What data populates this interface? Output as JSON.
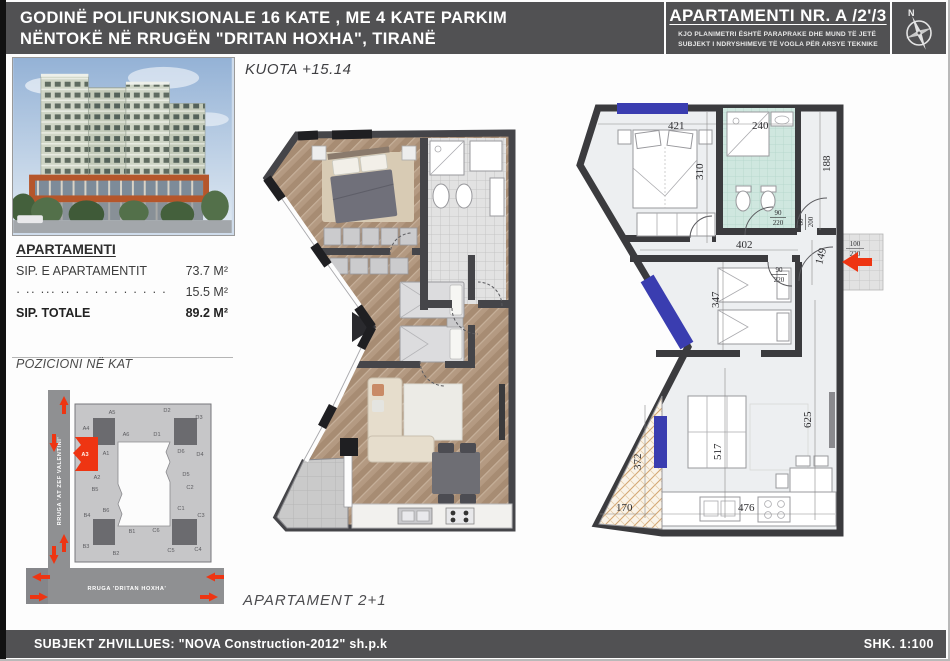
{
  "header": {
    "title_line1": "GODINË POLIFUNKSIONALE 16 KATE , ME 4 KATE PARKIM",
    "title_line2": "NËNTOKË NË RRUGËN \"DRITAN HOXHA\", TIRANË",
    "apartment_no": "APARTAMENTI NR. A /2'/3",
    "disclaimer1": "KJO PLANIMETRI ËSHTË PARAPRAKE DHE MUND TË JETË",
    "disclaimer2": "SUBJEKT I NDRYSHIMEVE TË VOGLA PËR ARSYE TEKNIKE",
    "compass": "N"
  },
  "sidebar": {
    "apartment_table": {
      "heading": "APARTAMENTI",
      "rows": [
        {
          "label": "SIP. E APARTAMENTIT",
          "value": "73.7 M²"
        },
        {
          "label": "· ·· ··· ·· · · · · · · · · · ·",
          "value": "15.5 M²"
        },
        {
          "label": "SIP. TOTALE",
          "value": "89.2 M²"
        }
      ]
    },
    "position_title": "POZICIONI NË KAT",
    "map": {
      "street_vertical": "RRUGA 'AT ZEF VALENTINI'",
      "street_horizontal": "RRUGA 'DRITAN HOXHA'",
      "highlight_unit": "A3",
      "units": [
        {
          "id": "A5",
          "x": 112,
          "y": 414
        },
        {
          "id": "D2",
          "x": 167,
          "y": 412
        },
        {
          "id": "D3",
          "x": 199,
          "y": 419
        },
        {
          "id": "A4",
          "x": 86,
          "y": 430
        },
        {
          "id": "A6",
          "x": 126,
          "y": 436
        },
        {
          "id": "D1",
          "x": 157,
          "y": 436
        },
        {
          "id": "A3",
          "x": 85,
          "y": 456,
          "hl": true
        },
        {
          "id": "A1",
          "x": 106,
          "y": 455
        },
        {
          "id": "D6",
          "x": 181,
          "y": 453
        },
        {
          "id": "D4",
          "x": 200,
          "y": 456
        },
        {
          "id": "A2",
          "x": 97,
          "y": 479
        },
        {
          "id": "D5",
          "x": 186,
          "y": 476
        },
        {
          "id": "B5",
          "x": 95,
          "y": 491
        },
        {
          "id": "C2",
          "x": 190,
          "y": 489
        },
        {
          "id": "B6",
          "x": 106,
          "y": 512
        },
        {
          "id": "C1",
          "x": 181,
          "y": 510
        },
        {
          "id": "B4",
          "x": 87,
          "y": 517
        },
        {
          "id": "C3",
          "x": 201,
          "y": 517
        },
        {
          "id": "B1",
          "x": 132,
          "y": 533
        },
        {
          "id": "C6",
          "x": 156,
          "y": 532
        },
        {
          "id": "B3",
          "x": 86,
          "y": 548
        },
        {
          "id": "B2",
          "x": 116,
          "y": 555
        },
        {
          "id": "C5",
          "x": 171,
          "y": 552
        },
        {
          "id": "C4",
          "x": 198,
          "y": 551
        }
      ]
    }
  },
  "center": {
    "kuota": "KUOTA +15.14",
    "apartment_type": "APARTAMENT  2+1"
  },
  "plan2d": {
    "dims": {
      "d421": "421",
      "d240": "240",
      "d310": "310",
      "d188": "188",
      "d402": "402",
      "d347": "347",
      "d149": "149",
      "d517": "517",
      "d625": "625",
      "d372": "372",
      "d170": "170",
      "d476": "476",
      "door_w": "90",
      "door_h": "220",
      "entry_w": "100",
      "entry_h": "220",
      "bathdoor_w": "80",
      "bathdoor_h": "200"
    }
  },
  "footer": {
    "developer": "SUBJEKT ZHVILLUES: \"NOVA Construction-2012\" sh.p.k",
    "scale": "SHK. 1:100"
  },
  "colors": {
    "header_gray": "#515153",
    "accent_red": "#ee3512",
    "window_blue": "#3a3db0",
    "bath_mint": "#cfe7df"
  }
}
